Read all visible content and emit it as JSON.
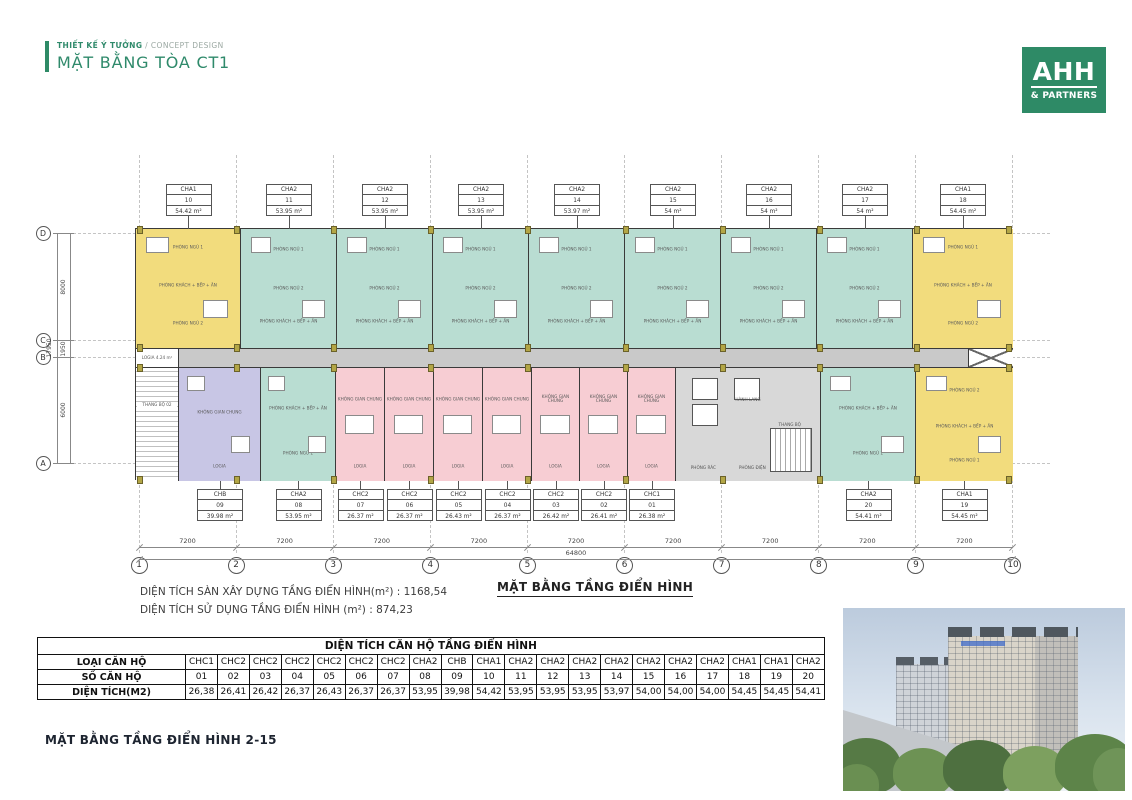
{
  "header": {
    "eyebrow_bold": "THIẾT KẾ Ý TƯỞNG",
    "eyebrow_light": " / CONCEPT DESIGN",
    "title": "MẶT BẰNG TÒA CT1"
  },
  "logo": {
    "line1": "AHH",
    "line2": "& PARTNERS"
  },
  "colors": {
    "brand_green": "#2E8A66",
    "unit_yellow": "#F2DC7D",
    "unit_teal": "#B9DDD2",
    "unit_pink": "#F7CDD3",
    "unit_purple": "#C8C6E5",
    "corridor_gray": "#C9C9C9",
    "core_gray": "#D8D8D8",
    "wall": "#3A3A3A",
    "column_olive": "#B3A646"
  },
  "plan": {
    "grid_cols": [
      "1",
      "2",
      "3",
      "4",
      "5",
      "6",
      "7",
      "8",
      "9",
      "10"
    ],
    "grid_rows": [
      "D",
      "C",
      "B",
      "A"
    ],
    "col_dims": [
      "7200",
      "7200",
      "7200",
      "7200",
      "7200",
      "7200",
      "7200",
      "7200",
      "7200"
    ],
    "col_total": "64800",
    "row_dims": [
      "8000",
      "1950",
      "6000"
    ],
    "row_total": "17950",
    "corridor_left_label": "LOGIA 4.24 m²",
    "corridor_name": "HÀNH LANG",
    "stair_label": "THANG BỘ 02",
    "room_labels": {
      "teal_top": [
        "PHÒNG NGỦ 1",
        "PHÒNG NGỦ 2",
        "PHÒNG KHÁCH + BẾP + ĂN"
      ],
      "yellow_top": [
        "PHÒNG NGỦ 1",
        "PHÒNG KHÁCH + BẾP + ĂN",
        "PHÒNG NGỦ 2"
      ],
      "yellow_bottom": [
        "PHÒNG NGỦ 2",
        "PHÒNG KHÁCH + BẾP + ĂN",
        "PHÒNG NGỦ 1"
      ],
      "teal_bottom": [
        "PHÒNG KHÁCH + BẾP + ĂN",
        "PHÒNG NGỦ 1"
      ],
      "pink": [
        "KHÔNG GIAN CHUNG",
        "LOGIA"
      ],
      "purple": [
        "KHÔNG GIAN CHUNG",
        "LOGIA"
      ],
      "core": [
        "HÀNH LANG",
        "PHÒNG RÁC",
        "PHÒNG ĐIỆN",
        "THANG BỘ"
      ]
    },
    "top_units": [
      {
        "type": "CHA1",
        "no": "10",
        "area": "54.42 m²",
        "color": "yellow",
        "w": 105
      },
      {
        "type": "CHA2",
        "no": "11",
        "area": "53.95 m²",
        "color": "teal",
        "w": 96
      },
      {
        "type": "CHA2",
        "no": "12",
        "area": "53.95 m²",
        "color": "teal",
        "w": 96
      },
      {
        "type": "CHA2",
        "no": "13",
        "area": "53.95 m²",
        "color": "teal",
        "w": 96
      },
      {
        "type": "CHA2",
        "no": "14",
        "area": "53.97 m²",
        "color": "teal",
        "w": 96
      },
      {
        "type": "CHA2",
        "no": "15",
        "area": "54 m²",
        "color": "teal",
        "w": 96
      },
      {
        "type": "CHA2",
        "no": "16",
        "area": "54 m²",
        "color": "teal",
        "w": 96
      },
      {
        "type": "CHA2",
        "no": "17",
        "area": "54 m²",
        "color": "teal",
        "w": 96
      },
      {
        "type": "CHA1",
        "no": "18",
        "area": "54.45 m²",
        "color": "yellow",
        "w": 100
      }
    ],
    "bottom_units": [
      {
        "kind": "stair",
        "w": 43
      },
      {
        "kind": "unit",
        "type": "CHB",
        "no": "09",
        "area": "39.98 m²",
        "color": "purple",
        "w": 82
      },
      {
        "kind": "unit",
        "type": "CHA2",
        "no": "08",
        "area": "53.95 m²",
        "color": "teal",
        "w": 75
      },
      {
        "kind": "unit",
        "type": "CHC2",
        "no": "07",
        "area": "26.37 m²",
        "color": "pink",
        "w": 49
      },
      {
        "kind": "unit",
        "type": "CHC2",
        "no": "06",
        "area": "26.37 m²",
        "color": "pink",
        "w": 49
      },
      {
        "kind": "unit",
        "type": "CHC2",
        "no": "05",
        "area": "26.43 m²",
        "color": "pink",
        "w": 49
      },
      {
        "kind": "unit",
        "type": "CHC2",
        "no": "04",
        "area": "26.37 m²",
        "color": "pink",
        "w": 49
      },
      {
        "kind": "unit",
        "type": "CHC2",
        "no": "03",
        "area": "26.42 m²",
        "color": "pink",
        "w": 48
      },
      {
        "kind": "unit",
        "type": "CHC2",
        "no": "02",
        "area": "26.41 m²",
        "color": "pink",
        "w": 48
      },
      {
        "kind": "unit",
        "type": "CHC1",
        "no": "01",
        "area": "26.38 m²",
        "color": "pink",
        "w": 48
      },
      {
        "kind": "core",
        "w": 145
      },
      {
        "kind": "unit",
        "type": "CHA2",
        "no": "20",
        "area": "54.41 m²",
        "color": "teal",
        "w": 95
      },
      {
        "kind": "unit",
        "type": "CHA1",
        "no": "19",
        "area": "54.45 m²",
        "color": "yellow",
        "w": 97
      }
    ]
  },
  "summary": {
    "line1": "DIỆN TÍCH SÀN XÂY DỰNG TẦNG ĐIỂN HÌNH(m²) : 1168,54",
    "line2": "DIỆN TÍCH SỬ DỤNG TẦNG ĐIỂN HÌNH (m²) : 874,23",
    "plan_title": "MẶT BẰNG TẦNG ĐIỂN HÌNH"
  },
  "table": {
    "title": "DIỆN TÍCH CĂN HỘ TẦNG ĐIỂN HÌNH",
    "row_labels": [
      "LOẠI CĂN HỘ",
      "SỐ CĂN HỘ",
      "DIỆN TÍCH(M2)"
    ],
    "types": [
      "CHC1",
      "CHC2",
      "CHC2",
      "CHC2",
      "CHC2",
      "CHC2",
      "CHC2",
      "CHA2",
      "CHB",
      "CHA1",
      "CHA2",
      "CHA2",
      "CHA2",
      "CHA2",
      "CHA2",
      "CHA2",
      "CHA2",
      "CHA1",
      "CHA1",
      "CHA2"
    ],
    "numbers": [
      "01",
      "02",
      "03",
      "04",
      "05",
      "06",
      "07",
      "08",
      "09",
      "10",
      "11",
      "12",
      "13",
      "14",
      "15",
      "16",
      "17",
      "18",
      "19",
      "20"
    ],
    "areas": [
      "26,38",
      "26,41",
      "26,42",
      "26,37",
      "26,43",
      "26,37",
      "26,37",
      "53,95",
      "39,98",
      "54,42",
      "53,95",
      "53,95",
      "53,95",
      "53,97",
      "54,00",
      "54,00",
      "54,00",
      "54,45",
      "54,45",
      "54,41"
    ]
  },
  "caption": "MẶT BẰNG TẦNG ĐIỂN HÌNH 2-15"
}
